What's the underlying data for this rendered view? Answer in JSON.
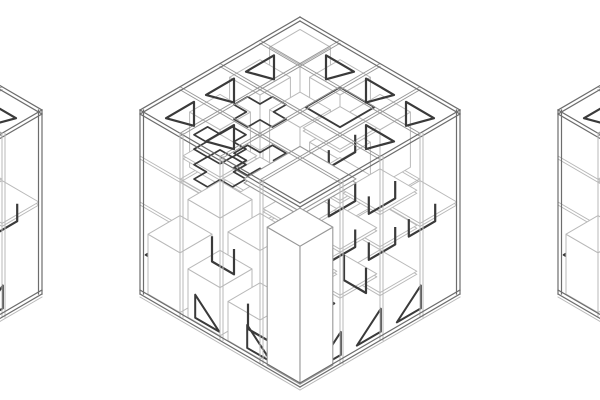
{
  "page": {
    "title": "axonometric-cube-lattice-drawing",
    "description": "Three isometric wireframe cube structures, center cube fully visible, left and right cubes cropped at image edges"
  },
  "scene": {
    "width": 600,
    "height": 400,
    "background": "#ffffff",
    "colors": {
      "light": "#b9b9b9",
      "mid": "#989898",
      "frame": "#6d6d6d",
      "dark": "#3a3a3a",
      "fill": "#ffffff"
    },
    "iso": {
      "apex_y": 17,
      "cell_dx": 40,
      "cell_dy": 23.25,
      "cell_dz": 46,
      "cells": 4
    },
    "cubes": [
      {
        "id": "cube-left",
        "cx": -118
      },
      {
        "id": "cube-center",
        "cx": 300
      },
      {
        "id": "cube-right",
        "cx": 718
      }
    ]
  },
  "structure": {
    "ring_beams": [
      {
        "dir": "u",
        "j": 2,
        "z": 3.0
      },
      {
        "dir": "v",
        "i": 2,
        "z": 3.0
      },
      {
        "dir": "u",
        "j": 3,
        "z": 2.0
      },
      {
        "dir": "v",
        "i": 3,
        "z": 2.0
      },
      {
        "dir": "u",
        "j": 1,
        "z": 3.0
      },
      {
        "dir": "v",
        "i": 1,
        "z": 3.0
      }
    ],
    "face_rails": [
      {
        "face": "left",
        "z": 2.0
      },
      {
        "face": "left",
        "z": 3.0
      }
    ],
    "interior_columns": [
      [
        1,
        1
      ],
      [
        2,
        1
      ],
      [
        1,
        2
      ],
      [
        2,
        2
      ]
    ],
    "top_boxes": [
      [
        0,
        0,
        3.85
      ],
      [
        1,
        0,
        3.7
      ],
      [
        0,
        1,
        3.7
      ],
      [
        1,
        1,
        3.5
      ],
      [
        2,
        0,
        3.45
      ],
      [
        0,
        2,
        3.45
      ],
      [
        2,
        1,
        3.3
      ]
    ],
    "floor_boxes": [
      [
        0,
        2,
        1.55
      ],
      [
        0,
        3,
        1.3
      ],
      [
        1,
        2,
        1.35
      ],
      [
        1,
        3,
        1.05
      ],
      [
        2,
        3,
        0.85
      ]
    ],
    "platforms": [
      [
        3,
        1,
        1.0
      ],
      [
        3,
        1,
        2.0
      ],
      [
        3,
        2,
        1.45
      ],
      [
        3,
        2,
        2.45
      ],
      [
        3,
        0,
        2.0
      ],
      [
        2,
        1,
        2.5
      ],
      [
        0,
        1,
        1.5
      ],
      [
        0,
        2,
        2.5
      ],
      [
        1,
        2,
        2.0
      ],
      [
        2,
        2,
        1.0
      ],
      [
        1,
        1,
        1.35
      ],
      [
        2,
        0,
        1.75
      ],
      [
        2,
        2,
        3.1
      ],
      [
        1,
        0,
        2.6
      ]
    ],
    "big_plate": {
      "i": 1.15,
      "j": 1.15,
      "size": 1.4,
      "z": 2.35
    },
    "big_column": {
      "i": 3.12,
      "j": 3.12,
      "size": 0.82,
      "h": 3.0
    },
    "dark_diamonds": [
      [
        0,
        3,
        0.85
      ],
      [
        2,
        2,
        0.3
      ],
      [
        1,
        0,
        3.05
      ]
    ],
    "cross_plates": [
      [
        0.0,
        2.0,
        2.15
      ],
      [
        0.0,
        2.0,
        2.8
      ],
      [
        0.6,
        1.6,
        2.5
      ],
      [
        0.2,
        1.2,
        3.15
      ]
    ],
    "chevrons": [
      [
        3,
        1,
        1.35
      ],
      [
        3,
        1,
        2.35
      ],
      [
        3,
        2,
        1.8
      ],
      [
        3,
        2,
        2.8
      ],
      [
        3,
        0,
        1.35
      ],
      [
        2,
        1,
        2.85
      ]
    ],
    "staples": [
      [
        2.2,
        3.5,
        0.1
      ],
      [
        0.3,
        2.5,
        0.1
      ],
      [
        2.6,
        1.5,
        0.35
      ]
    ],
    "top_triangles": [
      [
        1,
        0,
        "R"
      ],
      [
        2,
        0,
        "R"
      ],
      [
        3,
        0,
        "R"
      ],
      [
        3,
        1,
        "R"
      ],
      [
        0,
        1,
        "L"
      ],
      [
        0,
        2,
        "L"
      ],
      [
        0,
        3,
        "L"
      ],
      [
        1,
        3,
        "L"
      ]
    ],
    "floor_triangles": [
      [
        2.5,
        "L"
      ],
      [
        1.2,
        "L"
      ],
      [
        2.8,
        "R"
      ],
      [
        0.8,
        "R"
      ],
      [
        1.8,
        "R"
      ]
    ]
  }
}
